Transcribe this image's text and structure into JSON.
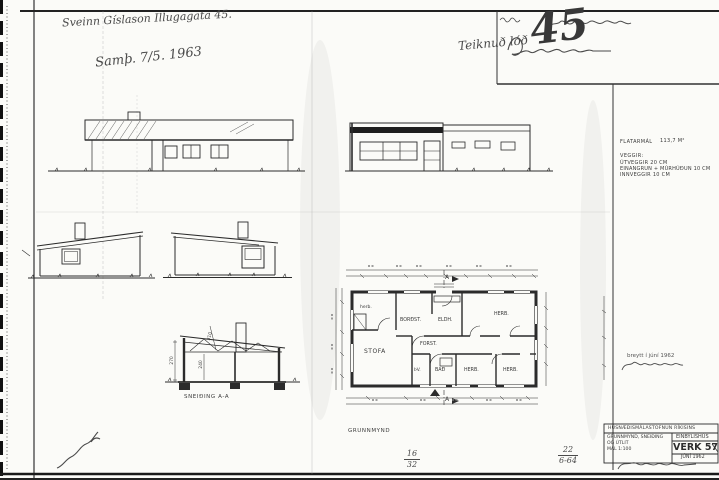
{
  "annotations": {
    "owner": "Sveinn Gíslason Illugagata 45.",
    "approved": "Samþ. 7/5. 1963",
    "lot_note": "Teiknuð lóð",
    "lot_number": "45",
    "changed_note": "breytt í júní 1962",
    "fr1n": "16",
    "fr1d": "32",
    "fr2n": "22",
    "fr2d": "6-64"
  },
  "specs": {
    "area_label": "FLATARMÁL",
    "area_value": "113,7 M²",
    "walls_heading": "VEGGIR:",
    "wall_lines": [
      "ÚTVEGGIR  20 CM",
      "EINANGRUN + MÚRHÚÐUN  10 CM",
      "INNVEGGIR  10 CM"
    ]
  },
  "titleblock": {
    "agency": "HÚSNÆÐISMÁLASTOFNUN RÍKISINS",
    "contents1": "GRUNNMYND, SNEIÐING",
    "contents2": "OG ÚTLIT",
    "scale": "MÁL 1:100",
    "type": "EINBÝLISHÚS",
    "project": "VERK 57",
    "date": "JÚNÍ 1962"
  },
  "drawings": {
    "plan_label": "GRUNNMYND",
    "section_label": "SNEIÐING A-A",
    "marker_a": "A",
    "dims": {
      "wall_height": "270",
      "room_height": "240",
      "truss": "310"
    },
    "rooms": {
      "herb_small": "herb.",
      "dining": "BORÐST.",
      "kitchen": "ELDH.",
      "hall": "FORST.",
      "living": "STOFA",
      "laundry": "ÞV.",
      "bath": "BAÐ",
      "bed_top": "HERB.",
      "bed_mid": "HERB.",
      "bed_right": "HERB."
    }
  }
}
